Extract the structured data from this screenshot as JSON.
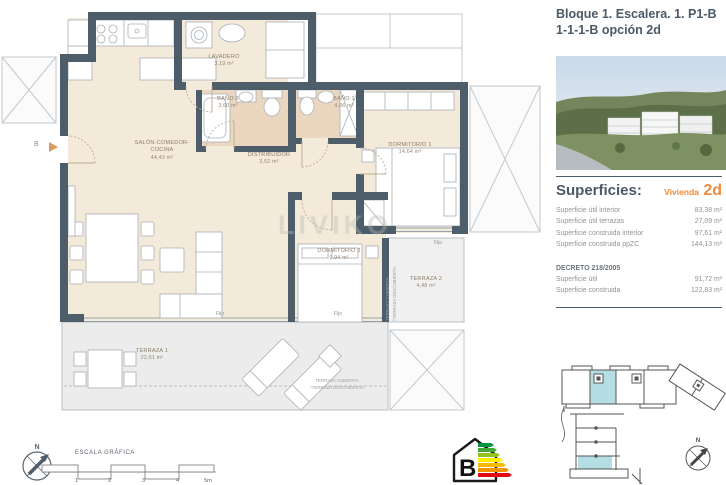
{
  "title": {
    "line1": "Bloque 1. Escalera. 1. P1-B",
    "line2": "1-1-1-B opción 2d"
  },
  "superficies": {
    "heading": "Superficies:",
    "vivienda_label": "Vivienda",
    "vivienda_value": "2d",
    "rows": [
      {
        "label": "Superficie útil interior",
        "value": "83,38 m²"
      },
      {
        "label": "Superficie útil terrazas",
        "value": "27,09 m²"
      },
      {
        "label": "Superficie construida interior",
        "value": "97,61 m²"
      },
      {
        "label": "Superficie construida ppZC",
        "value": "144,13 m²"
      }
    ],
    "decreto_heading": "DECRETO 218/2005",
    "decreto_rows": [
      {
        "label": "Superficie útil",
        "value": "91,72 m²"
      },
      {
        "label": "Superficie construida",
        "value": "122,83 m²"
      }
    ]
  },
  "plan": {
    "rooms": [
      {
        "name": "LAVADERO",
        "area": "3,19 m²"
      },
      {
        "name": "BAÑO 2",
        "area": "3,60 m²"
      },
      {
        "name": "BAÑO 1",
        "area": "4,06 m²"
      },
      {
        "name": "SALÓN-COMEDOR-COCINA",
        "area": "44,43 m²"
      },
      {
        "name": "DISTRIBUIDOR",
        "area": "3,52 m²"
      },
      {
        "name": "DORMITORIO 1",
        "area": "14,64 m²"
      },
      {
        "name": "DORMITORIO 2",
        "area": "9,94 m²"
      },
      {
        "name": "TERRAZA 2",
        "area": "4,48 m²"
      },
      {
        "name": "TERRAZA 1",
        "area": "22,61 m²"
      }
    ],
    "annotations": {
      "fijo": "Fijo",
      "entry_label": "B",
      "terraza_cubierta": "TERRAZA CUBIERTA",
      "terraza_descubierta": "*TERRAZA DESCUBIERTA"
    },
    "scale": {
      "label": "ESCALA GRÁFICA",
      "ticks": [
        "1",
        "2",
        "3",
        "4",
        "5m"
      ]
    },
    "north_label": "N",
    "energy_rating": "B"
  },
  "watermark": "LIVIKO",
  "colors": {
    "wall": "#4e5d6a",
    "floor": "#f4ead9",
    "bath_floor": "#ebd6bf",
    "terrace": "#ececec",
    "accent_orange": "#ee8a3c",
    "highlight_blue": "#b5dde4",
    "energy_scale": [
      "#009640",
      "#3faa35",
      "#95c11f",
      "#ffed00",
      "#fbba00",
      "#f39200",
      "#e30613"
    ]
  }
}
